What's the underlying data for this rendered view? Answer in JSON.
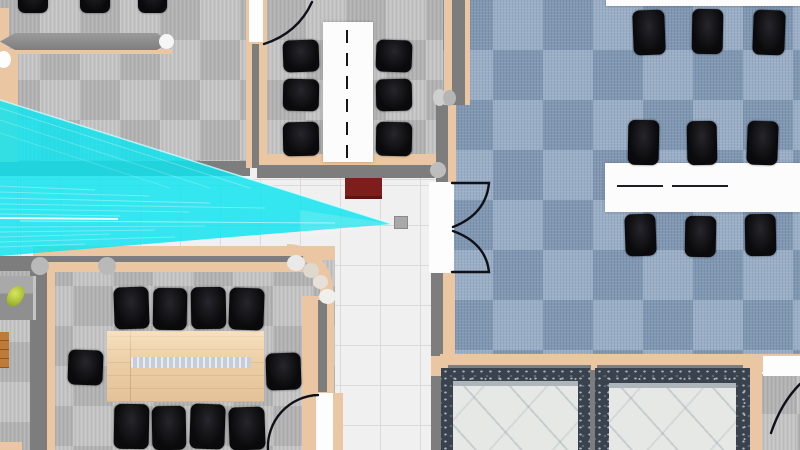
{
  "scene": {
    "description": "Top-down 2D floor plan of an office environment with a cyan robot sensor field-of-view cone projecting from the left edge",
    "sensor": {
      "name": "fov-cone",
      "type": "lidar-field-of-view",
      "color": "#10E3EE",
      "origin": "left-edge",
      "apex": [
        392,
        224
      ],
      "polygon": [
        [
          0,
          100
        ],
        [
          392,
          224
        ],
        [
          0,
          256
        ]
      ]
    },
    "robot": {
      "x": 394,
      "y": 216,
      "w": 14,
      "h": 13,
      "color": "#a9a9a9"
    },
    "rooms": [
      {
        "name": "top-left-office",
        "floor": "gray-carpet",
        "chairs": 3,
        "features": [
          "reception-counter"
        ]
      },
      {
        "name": "top-middle-meeting-room",
        "floor": "gray-carpet",
        "chairs": 6,
        "tables": 1,
        "door": "arc-top-left"
      },
      {
        "name": "right-open-office",
        "floor": "blue-carpet",
        "chairs": 9,
        "tables": 2,
        "door": "double-door-west"
      },
      {
        "name": "bottom-left-conference-room",
        "floor": "gray-carpet",
        "chairs": 10,
        "tables": 1,
        "door": "arc-bottom-right"
      },
      {
        "name": "center-hallway",
        "floor": "white-tile",
        "features": [
          "red-cabinet"
        ]
      },
      {
        "name": "bottom-right-atrium",
        "floor": "gray-carpet",
        "features": [
          "marble-planter",
          "marble-planter"
        ],
        "door": "arc-corner"
      }
    ],
    "palette": {
      "gray_carpet": "#bdbdbd",
      "blue_carpet": "#90a6c0",
      "tile": "#f0f0f0",
      "wall_tan": "#eac7a2",
      "wall_gray": "#7d7d7d",
      "chair": "#0a0a0c",
      "wood_table": "#eccea5",
      "cone": "#10e3ee",
      "cabinet_red": "#7c1e1b",
      "marble": "#e5e8e5",
      "granite": "#39424d"
    },
    "furniture": [
      {
        "cls": "table-white",
        "name": "meeting-table",
        "x": 323,
        "y": 22,
        "w": 50,
        "h": 140,
        "children": [
          {
            "cls": "seam-v",
            "name": "table-seam",
            "x": 23,
            "y": 4,
            "w": 2,
            "h": 132
          }
        ]
      },
      {
        "cls": "table-white",
        "name": "office-table",
        "x": 605,
        "y": 163,
        "w": 195,
        "h": 49,
        "children": [
          {
            "cls": "seam-h",
            "name": "table-seam",
            "x": 12,
            "y": 22,
            "w": 46,
            "h": 2
          },
          {
            "cls": "seam-h",
            "name": "table-seam",
            "x": 67,
            "y": 22,
            "w": 56,
            "h": 2
          }
        ]
      },
      {
        "cls": "table-white",
        "name": "table-edge",
        "x": 606,
        "y": 0,
        "w": 194,
        "h": 6
      },
      {
        "cls": "table-wood",
        "name": "conference-table",
        "x": 107,
        "y": 331,
        "w": 157,
        "h": 71,
        "children": [
          {
            "cls": "cable-tray",
            "name": "cable-tray",
            "x": 24,
            "y": 26,
            "w": 120,
            "h": 11
          }
        ]
      },
      {
        "cls": "counter",
        "name": "reception-counter",
        "x": 0,
        "y": 33,
        "w": 176,
        "h": 17
      },
      {
        "cls": "cap",
        "name": "counter-endcap",
        "x": 159,
        "y": 34,
        "w": 15,
        "h": 15
      },
      {
        "cls": "side-desk",
        "name": "side-desk",
        "x": 0,
        "y": 276,
        "w": 33,
        "h": 44
      },
      {
        "cls": "plant",
        "name": "desk-plant",
        "x": 8,
        "y": 285,
        "w": 15,
        "h": 22,
        "rot": 25
      },
      {
        "cls": "wood-shelf",
        "name": "wood-shelf",
        "x": 0,
        "y": 332,
        "w": 9,
        "h": 36
      },
      {
        "cls": "red-cabinet",
        "name": "red-cabinet",
        "x": 345,
        "y": 178,
        "w": 37,
        "h": 18
      },
      {
        "cls": "planter",
        "name": "marble-planter",
        "x": 441,
        "y": 368,
        "w": 149,
        "h": 82,
        "children": [
          {
            "cls": "marble",
            "name": "marble-top",
            "x": 12,
            "y": 13,
            "w": 125,
            "h": 69
          }
        ]
      },
      {
        "cls": "planter",
        "name": "marble-planter",
        "x": 595,
        "y": 368,
        "w": 155,
        "h": 82,
        "children": [
          {
            "cls": "marble",
            "name": "marble-top",
            "x": 14,
            "y": 15,
            "w": 127,
            "h": 67
          }
        ]
      },
      {
        "cls": "chair",
        "name": "office-chair",
        "x": 18,
        "y": -20,
        "w": 30,
        "h": 33
      },
      {
        "cls": "chair",
        "name": "office-chair",
        "x": 80,
        "y": -20,
        "w": 30,
        "h": 33
      },
      {
        "cls": "chair",
        "name": "office-chair",
        "x": 138,
        "y": -20,
        "w": 29,
        "h": 33
      },
      {
        "cls": "chair",
        "name": "office-chair",
        "x": 283,
        "y": 40,
        "w": 36,
        "h": 32,
        "rot": -2
      },
      {
        "cls": "chair",
        "name": "office-chair",
        "x": 283,
        "y": 79,
        "w": 36,
        "h": 32,
        "rot": 1
      },
      {
        "cls": "chair",
        "name": "office-chair",
        "x": 283,
        "y": 122,
        "w": 36,
        "h": 34,
        "rot": -1
      },
      {
        "cls": "chair",
        "name": "office-chair",
        "x": 376,
        "y": 40,
        "w": 36,
        "h": 32,
        "rot": 2
      },
      {
        "cls": "chair",
        "name": "office-chair",
        "x": 376,
        "y": 79,
        "w": 36,
        "h": 32,
        "rot": -1
      },
      {
        "cls": "chair",
        "name": "office-chair",
        "x": 376,
        "y": 122,
        "w": 36,
        "h": 34,
        "rot": 1
      },
      {
        "cls": "chair",
        "name": "office-chair",
        "x": 633,
        "y": 10,
        "w": 32,
        "h": 45,
        "rot": -2
      },
      {
        "cls": "chair",
        "name": "office-chair",
        "x": 692,
        "y": 9,
        "w": 31,
        "h": 45,
        "rot": 1
      },
      {
        "cls": "chair",
        "name": "office-chair",
        "x": 753,
        "y": 10,
        "w": 32,
        "h": 45,
        "rot": 2
      },
      {
        "cls": "chair",
        "name": "office-chair",
        "x": 628,
        "y": 120,
        "w": 31,
        "h": 45,
        "rot": 1
      },
      {
        "cls": "chair",
        "name": "office-chair",
        "x": 687,
        "y": 121,
        "w": 30,
        "h": 44,
        "rot": -1
      },
      {
        "cls": "chair",
        "name": "office-chair",
        "x": 747,
        "y": 121,
        "w": 31,
        "h": 44,
        "rot": 2
      },
      {
        "cls": "chair",
        "name": "office-chair",
        "x": 625,
        "y": 214,
        "w": 31,
        "h": 42,
        "rot": -2
      },
      {
        "cls": "chair",
        "name": "office-chair",
        "x": 685,
        "y": 216,
        "w": 31,
        "h": 41,
        "rot": 1
      },
      {
        "cls": "chair",
        "name": "office-chair",
        "x": 745,
        "y": 214,
        "w": 31,
        "h": 42,
        "rot": -1
      },
      {
        "cls": "chair",
        "name": "office-chair",
        "x": 114,
        "y": 287,
        "w": 35,
        "h": 42,
        "rot": -2
      },
      {
        "cls": "chair",
        "name": "office-chair",
        "x": 153,
        "y": 288,
        "w": 34,
        "h": 42,
        "rot": 1
      },
      {
        "cls": "chair",
        "name": "office-chair",
        "x": 191,
        "y": 287,
        "w": 35,
        "h": 42,
        "rot": -1
      },
      {
        "cls": "chair",
        "name": "office-chair",
        "x": 229,
        "y": 288,
        "w": 35,
        "h": 42,
        "rot": 2
      },
      {
        "cls": "chair",
        "name": "office-chair",
        "x": 114,
        "y": 404,
        "w": 35,
        "h": 45,
        "rot": 1
      },
      {
        "cls": "chair",
        "name": "office-chair",
        "x": 152,
        "y": 406,
        "w": 34,
        "h": 44,
        "rot": -1
      },
      {
        "cls": "chair",
        "name": "office-chair",
        "x": 190,
        "y": 404,
        "w": 35,
        "h": 45,
        "rot": 2
      },
      {
        "cls": "chair",
        "name": "office-chair",
        "x": 229,
        "y": 407,
        "w": 36,
        "h": 43,
        "rot": -2
      },
      {
        "cls": "chair",
        "name": "office-chair",
        "x": 68,
        "y": 350,
        "w": 35,
        "h": 35,
        "rot": 2
      },
      {
        "cls": "chair",
        "name": "office-chair",
        "x": 266,
        "y": 353,
        "w": 35,
        "h": 37,
        "rot": -2
      }
    ]
  }
}
